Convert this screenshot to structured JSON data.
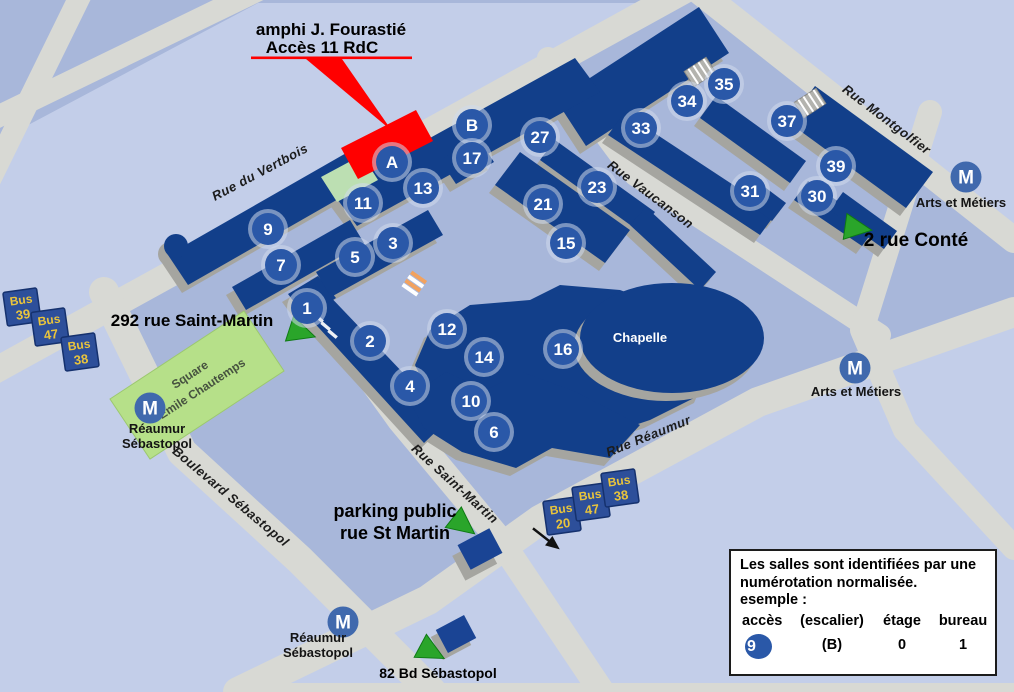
{
  "title": {
    "line1": "amphi J. Fourastié",
    "line2": "Accès 11 RdC"
  },
  "streets": [
    {
      "name": "Rue du Vertbois",
      "x": 262,
      "y": 176,
      "angle": -28
    },
    {
      "name": "Rue Montgolfier",
      "x": 884,
      "y": 123,
      "angle": 37
    },
    {
      "name": "Rue Vaucanson",
      "x": 648,
      "y": 198,
      "angle": 37
    },
    {
      "name": "Rue Réaumur",
      "x": 650,
      "y": 440,
      "angle": -22
    },
    {
      "name": "Rue Saint-Martin",
      "x": 452,
      "y": 487,
      "angle": 42
    },
    {
      "name": "Boulevard Sébastopol",
      "x": 228,
      "y": 500,
      "angle": 40
    }
  ],
  "access_points": [
    {
      "label": "A",
      "x": 392,
      "y": 162
    },
    {
      "label": "B",
      "x": 472,
      "y": 125
    },
    {
      "label": "1",
      "x": 307,
      "y": 308
    },
    {
      "label": "2",
      "x": 370,
      "y": 341
    },
    {
      "label": "3",
      "x": 393,
      "y": 243
    },
    {
      "label": "4",
      "x": 410,
      "y": 386
    },
    {
      "label": "5",
      "x": 355,
      "y": 257
    },
    {
      "label": "6",
      "x": 494,
      "y": 432
    },
    {
      "label": "7",
      "x": 281,
      "y": 265
    },
    {
      "label": "9",
      "x": 268,
      "y": 229
    },
    {
      "label": "10",
      "x": 471,
      "y": 401
    },
    {
      "label": "11",
      "x": 363,
      "y": 203
    },
    {
      "label": "12",
      "x": 447,
      "y": 329
    },
    {
      "label": "13",
      "x": 423,
      "y": 188
    },
    {
      "label": "14",
      "x": 484,
      "y": 357
    },
    {
      "label": "15",
      "x": 566,
      "y": 243
    },
    {
      "label": "16",
      "x": 563,
      "y": 349
    },
    {
      "label": "17",
      "x": 472,
      "y": 158
    },
    {
      "label": "21",
      "x": 543,
      "y": 204
    },
    {
      "label": "23",
      "x": 597,
      "y": 187
    },
    {
      "label": "27",
      "x": 540,
      "y": 137
    },
    {
      "label": "30",
      "x": 817,
      "y": 196
    },
    {
      "label": "31",
      "x": 750,
      "y": 191
    },
    {
      "label": "33",
      "x": 641,
      "y": 128
    },
    {
      "label": "34",
      "x": 687,
      "y": 101
    },
    {
      "label": "35",
      "x": 724,
      "y": 84
    },
    {
      "label": "37",
      "x": 787,
      "y": 121
    },
    {
      "label": "39",
      "x": 836,
      "y": 166
    }
  ],
  "metro_stations": [
    {
      "x": 150,
      "y": 408,
      "lines": [
        "Réaumur",
        "Sébastopol"
      ],
      "label_x": 157,
      "label_y": 433
    },
    {
      "x": 343,
      "y": 622,
      "lines": [
        "Réaumur",
        "Sébastopol"
      ],
      "label_x": 318,
      "label_y": 642
    },
    {
      "x": 966,
      "y": 177,
      "lines": [
        "Arts et Métiers"
      ],
      "label_x": 961,
      "label_y": 207
    },
    {
      "x": 855,
      "y": 368,
      "lines": [
        "Arts et Métiers"
      ],
      "label_x": 856,
      "label_y": 396
    }
  ],
  "bus_stops": [
    {
      "word": "Bus",
      "line": "39",
      "x": 22,
      "y": 307
    },
    {
      "word": "Bus",
      "line": "47",
      "x": 50,
      "y": 327
    },
    {
      "word": "Bus",
      "line": "38",
      "x": 80,
      "y": 352
    },
    {
      "word": "Bus",
      "line": "20",
      "x": 562,
      "y": 516
    },
    {
      "word": "Bus",
      "line": "47",
      "x": 591,
      "y": 502
    },
    {
      "word": "Bus",
      "line": "38",
      "x": 620,
      "y": 488
    }
  ],
  "entrances": [
    {
      "lines": [
        "292 rue Saint-Martin"
      ],
      "x": 192,
      "y": 326,
      "size": 17,
      "tx": 300,
      "ty": 332,
      "rot": 18
    },
    {
      "lines": [
        "2 rue Conté"
      ],
      "x": 916,
      "y": 246,
      "size": 19,
      "tx": 856,
      "ty": 228,
      "rot": 8
    },
    {
      "lines": [
        "parking public",
        "rue St Martin"
      ],
      "x": 395,
      "y": 517,
      "size": 18,
      "tx": 462,
      "ty": 524,
      "rot": 38
    },
    {
      "lines": [
        "82 Bd Sébastopol"
      ],
      "x": 438,
      "y": 678,
      "size": 14,
      "tx": 430,
      "ty": 651,
      "rot": 28
    }
  ],
  "places": {
    "chapelle": "Chapelle",
    "square_lines": [
      "Square",
      "Emile Chautemps"
    ]
  },
  "legend": {
    "text_lines": [
      "Les salles sont identifiées par une",
      "numérotation normalisée.",
      "esemple :"
    ],
    "columns": [
      "accès",
      "(escalier)",
      "étage",
      "bureau"
    ],
    "example": [
      "9",
      "(B)",
      "0",
      "1"
    ]
  },
  "colors": {
    "background": "#a8b7da",
    "background_light": "#c3cee9",
    "street": "#d8d9d4",
    "building": "#123f8a",
    "building_shadow": "#a5a5a0",
    "marker": "#2a58a8",
    "marker_halo": "#cfdaed",
    "metro": "#4069ad",
    "bus_bg": "#2d4f9a",
    "bus_border": "#15316e",
    "bus_text": "#e9c43c",
    "triangle_green": "#2aa52a",
    "park_green": "#b6e089",
    "lawn_green": "#bcdfb2",
    "highlight_red": "#ff0000"
  }
}
